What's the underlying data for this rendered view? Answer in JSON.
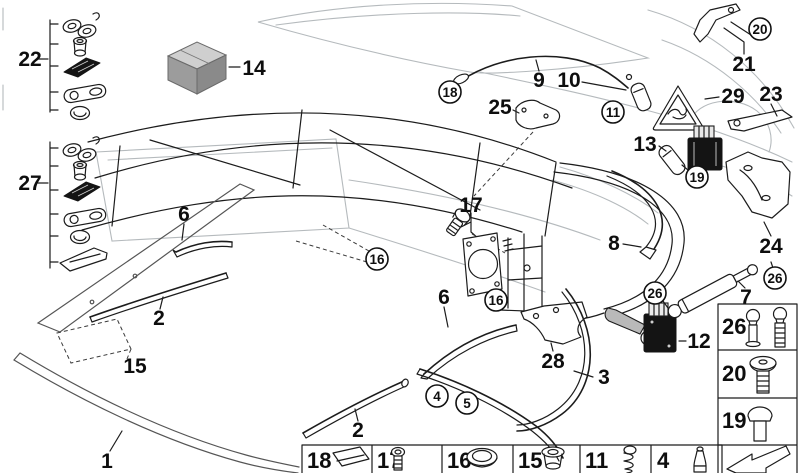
{
  "canvas": {
    "width": 800,
    "height": 473,
    "background": "#ffffff"
  },
  "colors": {
    "line": "#1c1c1c",
    "body_outline": "#b5babd",
    "part_dark_fill": "#141414",
    "box_top": "#cfcfcf",
    "box_left": "#9c9c9c",
    "box_right": "#8a8a8a"
  },
  "labels": {
    "n1": "1",
    "n2": "2",
    "n3": "3",
    "n4": "4",
    "n5": "5",
    "n6": "6",
    "n7": "7",
    "n8": "8",
    "n9": "9",
    "n10": "10",
    "n11": "11",
    "n12": "12",
    "n13": "13",
    "n14": "14",
    "n15": "15",
    "n16": "16",
    "n17": "17",
    "n18": "18",
    "n19": "19",
    "n20": "20",
    "n21": "21",
    "n22": "22",
    "n23": "23",
    "n24": "24",
    "n25": "25",
    "n26": "26",
    "n27": "27",
    "n28": "28",
    "n29": "29"
  },
  "legend_strip": {
    "cells": [
      {
        "num": "18",
        "icon": "pad-icon"
      },
      {
        "num": "17",
        "icon": "screw-icon"
      },
      {
        "num": "16",
        "icon": "dome-cap-icon"
      },
      {
        "num": "15",
        "icon": "grommet-icon"
      },
      {
        "num": "11",
        "icon": "spring-icon"
      },
      {
        "num": "4",
        "icon": "pin-icon"
      }
    ]
  },
  "side_panel": {
    "cells": [
      {
        "num": "26",
        "icon": "ball-stud-icon"
      },
      {
        "num": "20",
        "icon": "shoulder-bolt-icon"
      },
      {
        "num": "19",
        "icon": "mushroom-pin-icon"
      }
    ],
    "arrow_icon": "direction-arrow-icon"
  }
}
